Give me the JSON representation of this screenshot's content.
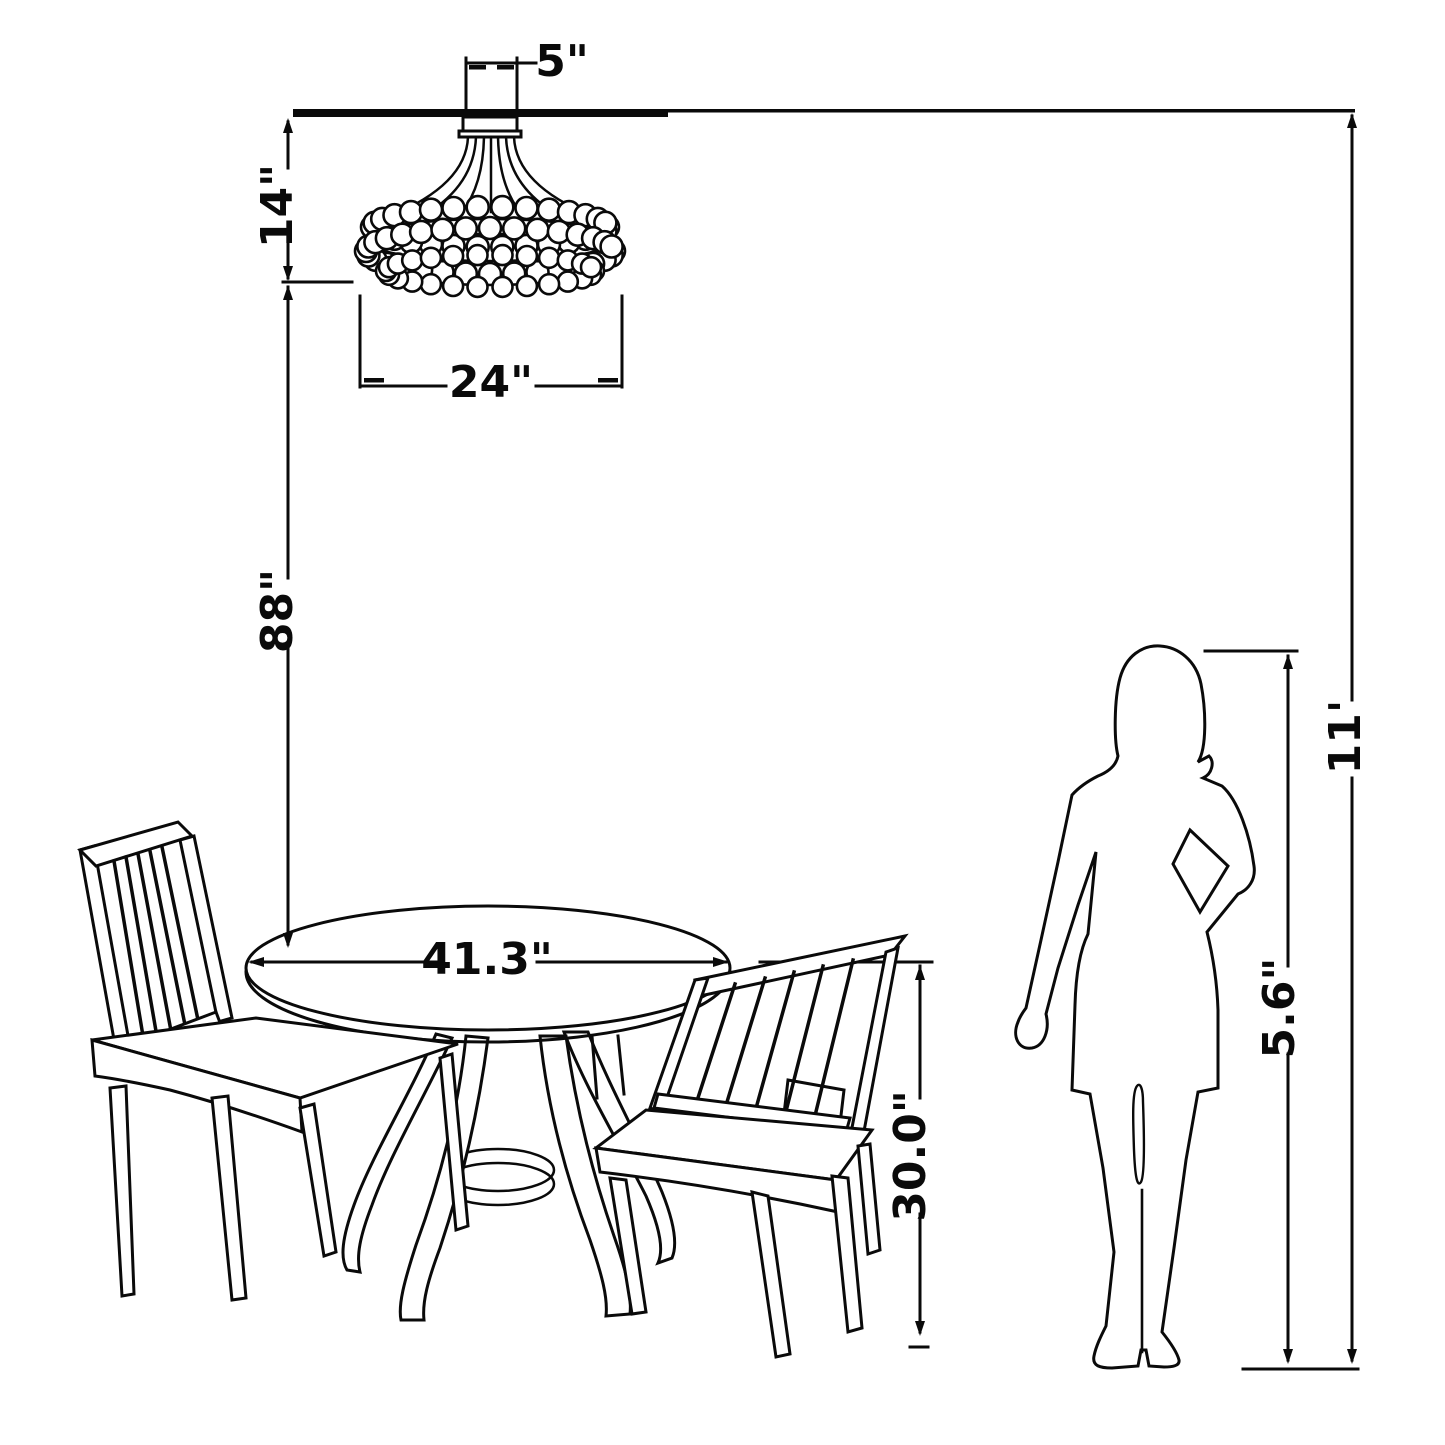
{
  "diagram": {
    "type": "furniture-dimension-drawing",
    "objects": [
      "flush-mount crystal chandelier",
      "round pedestal dining table",
      "slat-back dining chair left",
      "slat-back dining chair right",
      "woman silhouette"
    ],
    "line_color": "#0a0a0a",
    "background": "#ffffff",
    "labels": {
      "canopy_width": "5\"",
      "chandelier_height": "14\"",
      "chandelier_diameter": "24\"",
      "ceiling_to_table": "88\"",
      "table_diameter": "41.3\"",
      "table_height": "30.0\"",
      "person_height": "5.6\"",
      "ceiling_height": "11'"
    }
  }
}
